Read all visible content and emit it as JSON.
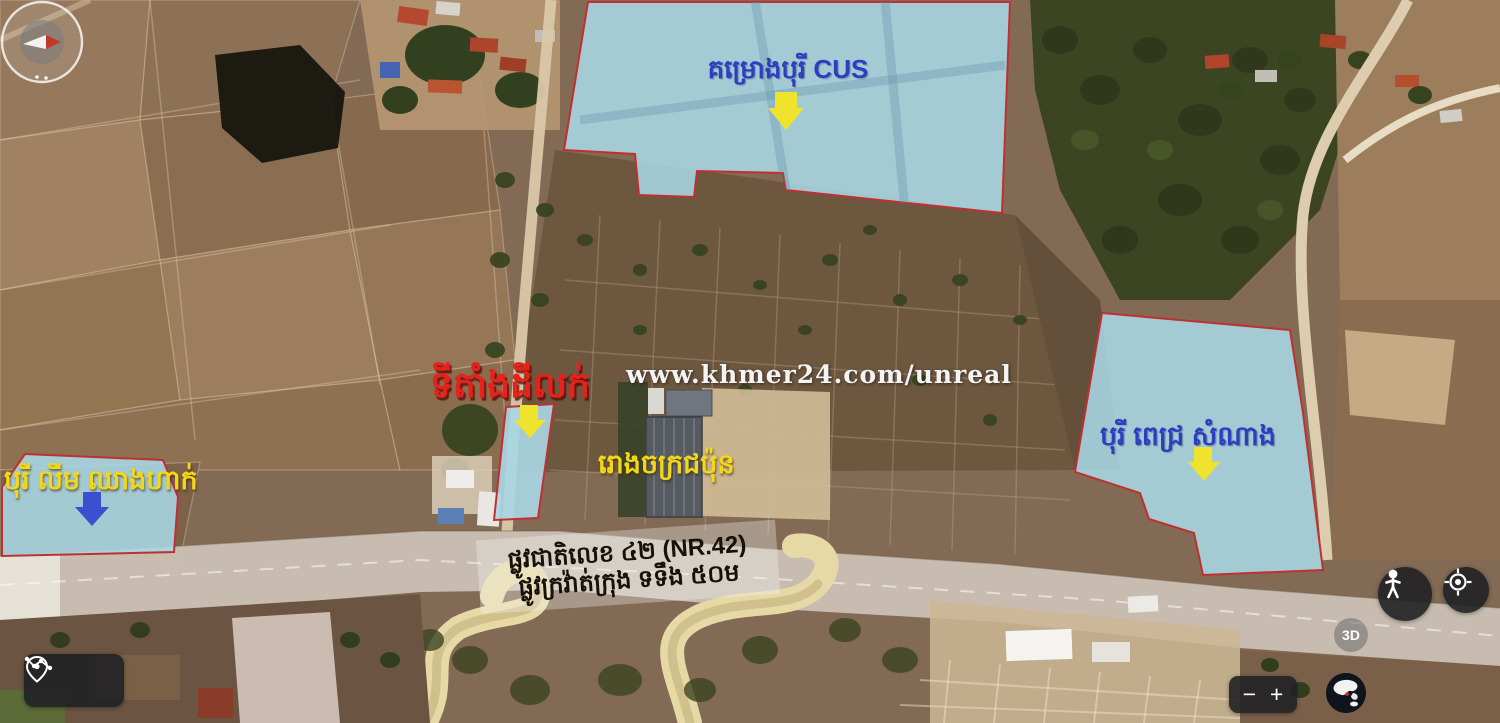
{
  "watermark": "www.khmer24.com/unreal",
  "annotations": {
    "project_cus": "គម្រោងបុរី CUS",
    "land_for_sale": "ទីតាំងដីលក់",
    "japanese_factory": "រោងចក្រជប៉ុន",
    "borey_lim_chheang_hak": "បុរី លីម ឈាងហាក់",
    "borey_pich_samnang": "បុរី ពេជ្រ សំណាង",
    "road_name": "ផ្លូវជាតិលេខ ៤២ (NR.42)",
    "road_detail": "ផ្លូវក្រវ៉ាត់ក្រុង ទទឹង ៥០ម"
  },
  "colors": {
    "parcel_fill": "#a8d7e6",
    "parcel_border": "#c03030",
    "arrow_yellow": "#efe32b",
    "arrow_blue": "#3a50cf",
    "label_blue": "#2e3ec2",
    "label_red": "#e8211a",
    "label_yellow": "#f2d818"
  },
  "controls": {
    "zoom_out": "−",
    "zoom_in": "+",
    "three_d": "3D"
  }
}
